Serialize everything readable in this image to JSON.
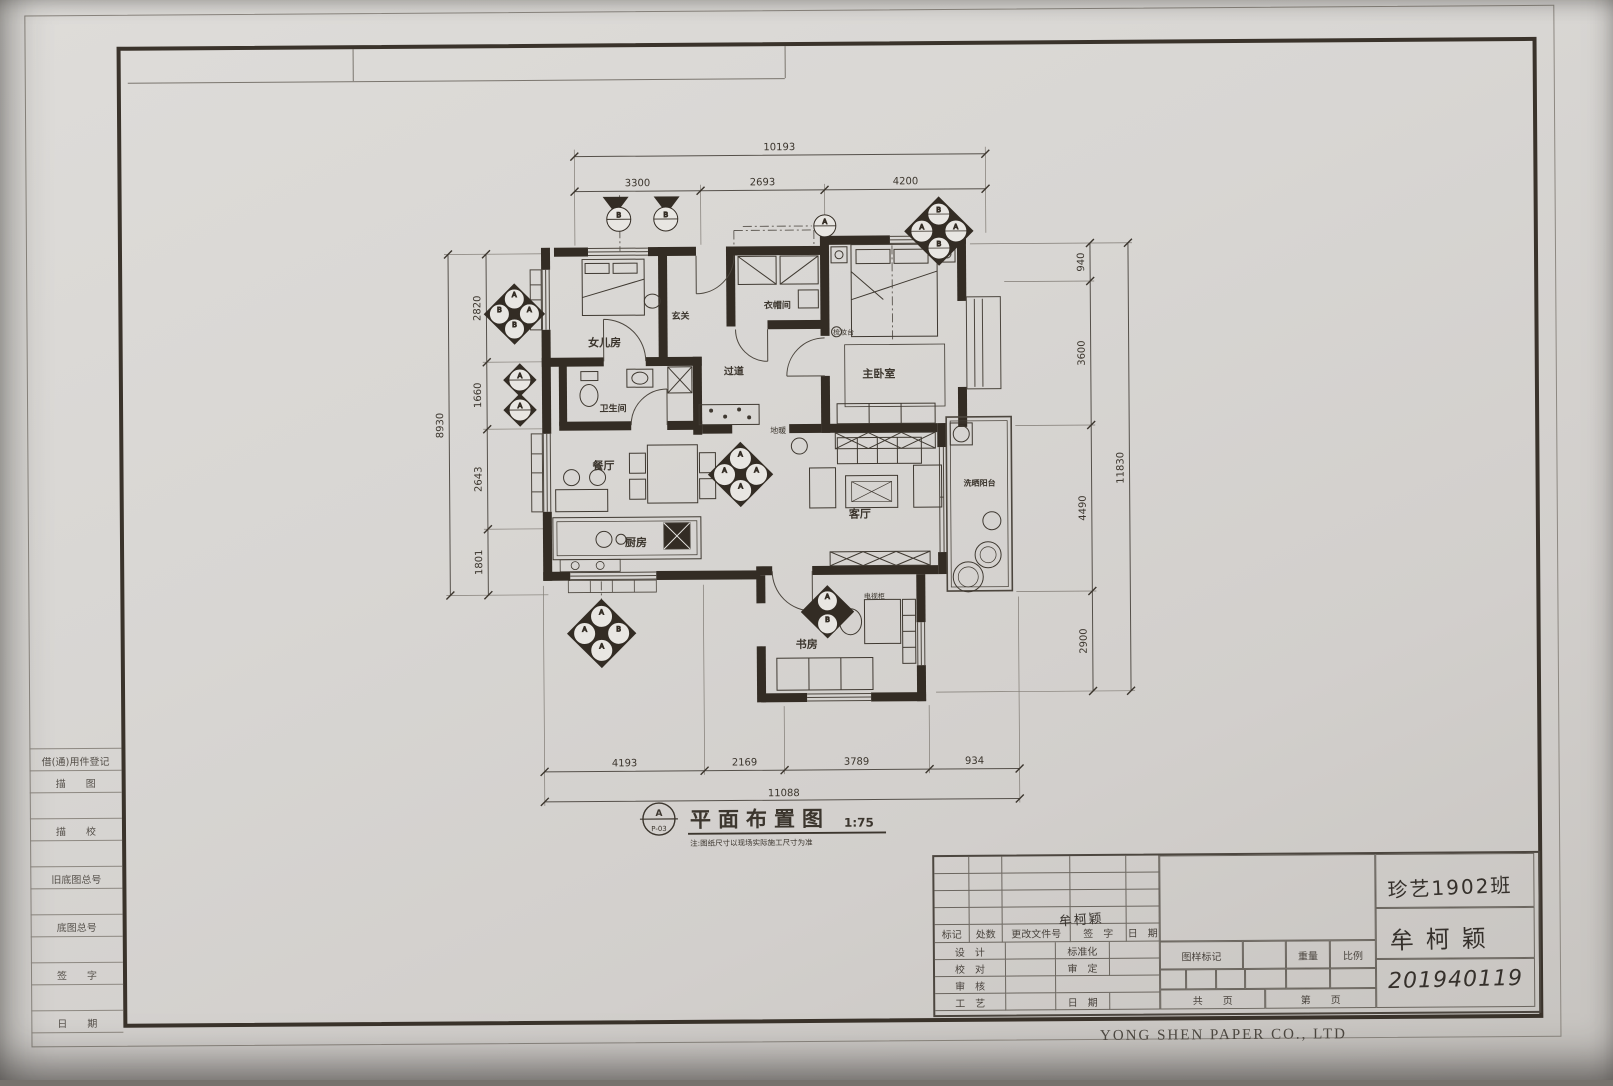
{
  "photo": {
    "company": "YONG SHEN PAPER CO., LTD"
  },
  "sidebar": {
    "register": "借(通)用件登记",
    "trace_draw": "描　　图",
    "trace_check": "描　　校",
    "old_base_no": "旧底图总号",
    "base_no": "底图总号",
    "sign": "签　　字",
    "date": "日　　期"
  },
  "plan": {
    "title": "平面布置图",
    "scale": "1:75",
    "tag_letter": "A",
    "tag_code": "P-03",
    "note": "注:图纸尺寸以现场实际施工尺寸为准",
    "rooms": {
      "daughter_room": "女儿房",
      "entry": "玄关",
      "cloakroom": "衣帽间",
      "hallway": "过道",
      "bathroom": "卫生间",
      "dining": "餐厅",
      "kitchen": "厨房",
      "living": "客厅",
      "master_bedroom": "主卧室",
      "study": "书房",
      "balcony": "洗晒阳台"
    },
    "labels": {
      "floor_heating": "地暖",
      "dressing_table": "梳妆台",
      "tv_cabinet": "电视柜"
    },
    "markers": {
      "a": "A",
      "b": "B"
    },
    "dims": {
      "top_total": "10193",
      "top_a": "3300",
      "top_b": "2693",
      "top_c": "4200",
      "left_total": "8930",
      "left_a": "2820",
      "left_b": "1660",
      "left_c": "2643",
      "left_d": "1801",
      "right_total": "11830",
      "right_a": "940",
      "right_b": "3600",
      "right_c": "4490",
      "right_d": "2900",
      "bottom_total": "11088",
      "bottom_a": "4193",
      "bottom_b": "2169",
      "bottom_c": "3789",
      "bottom_d": "934"
    }
  },
  "title_block": {
    "header": {
      "mark": "标记",
      "count": "处数",
      "change_no": "更改文件号",
      "sign": "签　字",
      "date": "日　期"
    },
    "rows": {
      "design": "设　计",
      "standardize": "标准化",
      "proofread": "校　对",
      "approve": "审　定",
      "review": "审　核",
      "craft": "工　艺",
      "date": "日　期"
    },
    "drawing_mark": "图样标记",
    "weight": "重量",
    "scale": "比例",
    "pages_total": "共　　页",
    "page_no": "第　　页",
    "handwritten": {
      "class_name": "珍艺1902班",
      "author": "牟柯颖",
      "student_id": "201940119",
      "signature": "牟柯颖"
    }
  }
}
